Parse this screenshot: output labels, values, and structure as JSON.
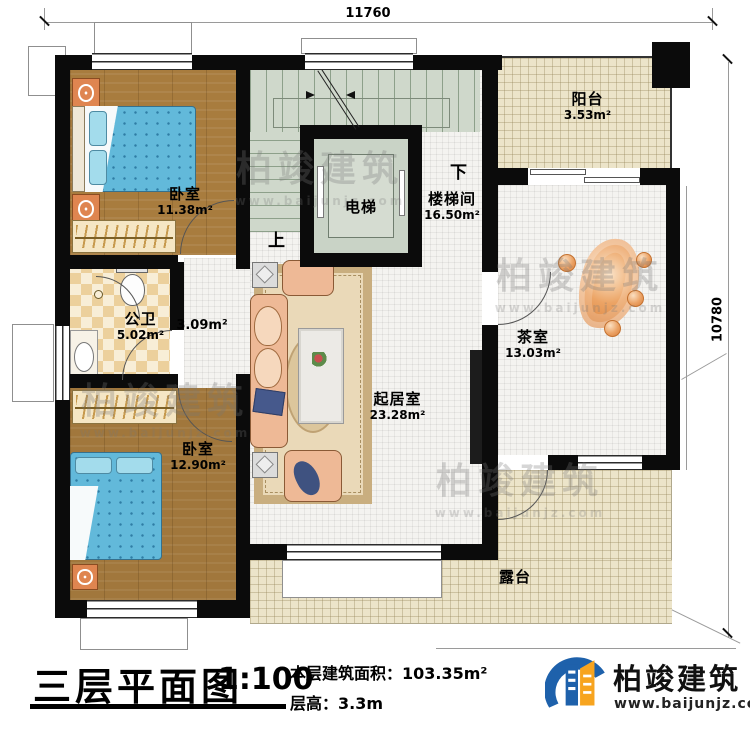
{
  "dimensions": {
    "top": "11760",
    "right": "10780"
  },
  "rooms": {
    "bedroom1": {
      "name": "卧室",
      "area": "11.38m²"
    },
    "stairwell": {
      "name": "楼梯间",
      "area": "16.50m²"
    },
    "elevator": {
      "name": "电梯"
    },
    "balcony": {
      "name": "阳台",
      "area": "3.53m²"
    },
    "tearoom": {
      "name": "茶室",
      "area": "13.03m²"
    },
    "bathroom": {
      "name": "公卫",
      "area": "5.02m²"
    },
    "hall": {
      "area": "3.09m²"
    },
    "bedroom2": {
      "name": "卧室",
      "area": "12.90m²"
    },
    "living": {
      "name": "起居室",
      "area": "23.28m²"
    },
    "terrace": {
      "name": "露台"
    }
  },
  "stairs": {
    "up": "上",
    "down": "下"
  },
  "title_block": {
    "title": "三层平面图",
    "scale": "1:100",
    "area_line": "本层建筑面积：103.35m²",
    "height_line": "层高：3.3m"
  },
  "brand": {
    "name": "柏竣建筑",
    "url": "www.baijunjz.com"
  },
  "watermark": {
    "name": "柏竣建筑",
    "url": "www.baijunjz.com"
  },
  "colors": {
    "wall": "#0b0b0b",
    "wood": "#a87c3e",
    "bed": "#62b9da",
    "stair": "#cfd8cb",
    "tile_beige": "#ece4c9",
    "checker": "#ecd09c",
    "decor_orange": "#e08a4e",
    "logo_blue": "#1e61ab",
    "logo_orange": "#f7a41f"
  }
}
